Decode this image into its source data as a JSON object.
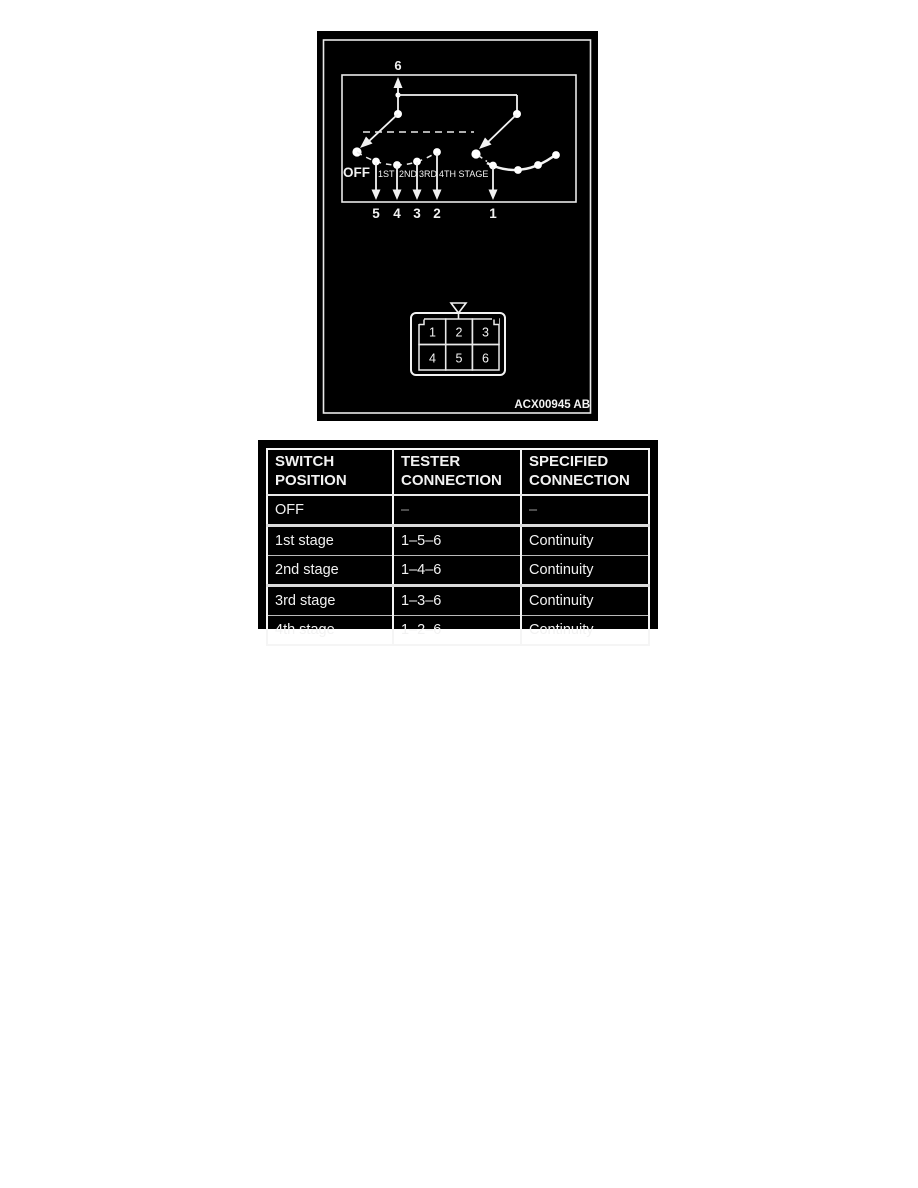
{
  "figure": {
    "code": "ACX00945 AB",
    "top_terminal": "6",
    "off_label": "OFF",
    "stages": [
      "1ST",
      "2ND",
      "3RD",
      "4TH STAGE"
    ],
    "terminals": [
      "5",
      "4",
      "3",
      "2",
      "1"
    ],
    "connector_pins": [
      "1",
      "2",
      "3",
      "4",
      "5",
      "6"
    ],
    "colors": {
      "panel_bg": "#000000",
      "line": "#f2f2f2"
    }
  },
  "table": {
    "headers": [
      {
        "line1": "SWITCH",
        "line2": "POSITION"
      },
      {
        "line1": "TESTER",
        "line2": "CONNECTION"
      },
      {
        "line1": "SPECIFIED",
        "line2": "CONNECTION"
      }
    ],
    "rows": [
      {
        "position": "OFF",
        "tester": "–",
        "specified": "–"
      },
      {
        "position": "1st stage",
        "tester": "1–5–6",
        "specified": "Continuity"
      },
      {
        "position": "2nd stage",
        "tester": "1–4–6",
        "specified": "Continuity"
      },
      {
        "position": "3rd stage",
        "tester": "1–3–6",
        "specified": "Continuity"
      },
      {
        "position": "4th stage",
        "tester": "1–2–6",
        "specified": "Continuity"
      }
    ]
  }
}
